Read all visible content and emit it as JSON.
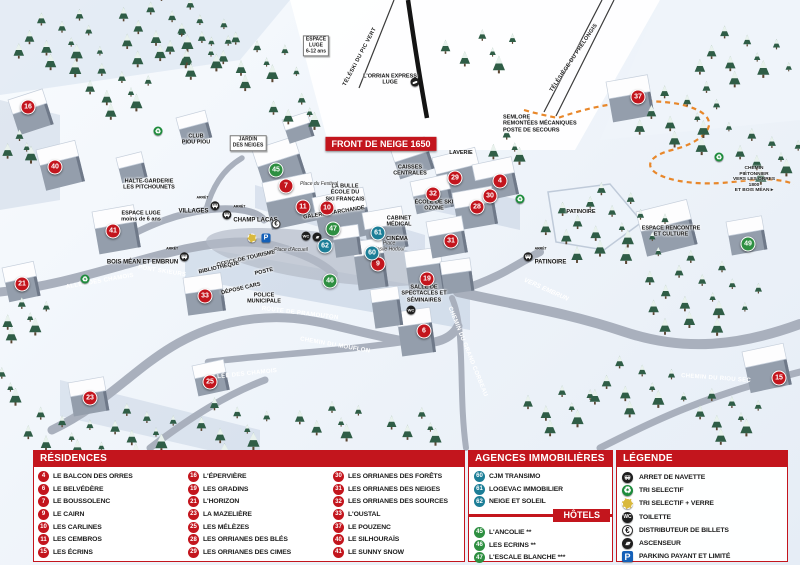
{
  "colors": {
    "residence": "#c3151d",
    "agence": "#1c7e97",
    "hotel": "#2e8f41",
    "legend_red": "#c3151d",
    "parking": "#1460b8",
    "path_orange": "#e8872a"
  },
  "map": {
    "arret_label": "ARRÊT",
    "markers": [
      {
        "n": "16",
        "c": "residence",
        "x": 28,
        "y": 107
      },
      {
        "n": "40",
        "c": "residence",
        "x": 55,
        "y": 167
      },
      {
        "n": "41",
        "c": "residence",
        "x": 113,
        "y": 231
      },
      {
        "n": "21",
        "c": "residence",
        "x": 22,
        "y": 284
      },
      {
        "n": "33",
        "c": "residence",
        "x": 205,
        "y": 296
      },
      {
        "n": "23",
        "c": "residence",
        "x": 90,
        "y": 398
      },
      {
        "n": "25",
        "c": "residence",
        "x": 210,
        "y": 382
      },
      {
        "n": "7",
        "c": "residence",
        "x": 286,
        "y": 186
      },
      {
        "n": "11",
        "c": "residence",
        "x": 303,
        "y": 207
      },
      {
        "n": "10",
        "c": "residence",
        "x": 327,
        "y": 208
      },
      {
        "n": "9",
        "c": "residence",
        "x": 378,
        "y": 264
      },
      {
        "n": "29",
        "c": "residence",
        "x": 455,
        "y": 178
      },
      {
        "n": "4",
        "c": "residence",
        "x": 500,
        "y": 181
      },
      {
        "n": "32",
        "c": "residence",
        "x": 433,
        "y": 194
      },
      {
        "n": "30",
        "c": "residence",
        "x": 490,
        "y": 196
      },
      {
        "n": "28",
        "c": "residence",
        "x": 477,
        "y": 207
      },
      {
        "n": "31",
        "c": "residence",
        "x": 451,
        "y": 241
      },
      {
        "n": "19",
        "c": "residence",
        "x": 427,
        "y": 279
      },
      {
        "n": "6",
        "c": "residence",
        "x": 424,
        "y": 331
      },
      {
        "n": "37",
        "c": "residence",
        "x": 638,
        "y": 97
      },
      {
        "n": "15",
        "c": "residence",
        "x": 779,
        "y": 378
      },
      {
        "n": "45",
        "c": "hotel",
        "x": 276,
        "y": 170
      },
      {
        "n": "47",
        "c": "hotel",
        "x": 333,
        "y": 229
      },
      {
        "n": "46",
        "c": "hotel",
        "x": 330,
        "y": 281
      },
      {
        "n": "49",
        "c": "hotel",
        "x": 748,
        "y": 244
      },
      {
        "n": "62",
        "c": "agence",
        "x": 325,
        "y": 246
      },
      {
        "n": "60",
        "c": "agence",
        "x": 372,
        "y": 253
      },
      {
        "n": "61",
        "c": "agence",
        "x": 378,
        "y": 233
      }
    ],
    "labels": [
      {
        "t": "FRONT DE NEIGE 1650",
        "x": 381,
        "y": 144,
        "cls": "banner"
      },
      {
        "t": "L'ORRIAN EXPRESS\nLUGE",
        "x": 390,
        "y": 80,
        "cls": "poi"
      },
      {
        "t": "TÉLÉSKI DU PIC VERT",
        "x": 360,
        "y": 57,
        "cls": "lift",
        "rot": -62
      },
      {
        "t": "TÉLÉSIÈGE DU PRÉLONGIS",
        "x": 574,
        "y": 58,
        "cls": "lift",
        "rot": -56
      },
      {
        "t": "SEMLORE\nREMONTÉES MÉCANIQUES\nPOSTE DE SECOURS",
        "x": 503,
        "y": 124,
        "cls": "poi poi-left"
      },
      {
        "t": "LAVERIE",
        "x": 461,
        "y": 153,
        "cls": "poi"
      },
      {
        "t": "CAISSES\nCENTRALES",
        "x": 410,
        "y": 171,
        "cls": "poi"
      },
      {
        "t": "LA BULLE\nÉCOLE DU\nSKI FRANÇAIS",
        "x": 345,
        "y": 193,
        "cls": "poi"
      },
      {
        "t": "ÉCOLE DE SKI\nOZONE",
        "x": 434,
        "y": 206,
        "cls": "poi"
      },
      {
        "t": "CABINET\nMÉDICAL",
        "x": 399,
        "y": 222,
        "cls": "poi"
      },
      {
        "t": "CINÉMA",
        "x": 397,
        "y": 239,
        "cls": "poi"
      },
      {
        "t": "GALERIE MARCHANDE",
        "x": 334,
        "y": 213,
        "cls": "poi",
        "rot": -9
      },
      {
        "t": "OFFICE DE TOURISME",
        "x": 246,
        "y": 259,
        "cls": "poi",
        "rot": -13
      },
      {
        "t": "POSTE",
        "x": 264,
        "y": 272,
        "cls": "poi",
        "rot": -13
      },
      {
        "t": "BIBLIOTHÈQUE",
        "x": 219,
        "y": 268,
        "cls": "poi",
        "rot": -13
      },
      {
        "t": "DÉPOSE CARS",
        "x": 241,
        "y": 289,
        "cls": "poi",
        "rot": -13
      },
      {
        "t": "POLICE\nMUNICIPALE",
        "x": 264,
        "y": 299,
        "cls": "poi"
      },
      {
        "t": "SALLE DE\nSPECTACLES ET\nSÉMINAIRES",
        "x": 424,
        "y": 294,
        "cls": "poi"
      },
      {
        "t": "PATINOIRE",
        "x": 581,
        "y": 212,
        "cls": "poi"
      },
      {
        "t": "ESPACE RENCONTRE\nET CULTURE",
        "x": 671,
        "y": 232,
        "cls": "poi"
      },
      {
        "t": "HALTE-GARDERIE\nLES PITCHOUNETS",
        "x": 149,
        "y": 185,
        "cls": "poi"
      },
      {
        "t": "ESPACE LUGE\nmoins de 6 ans",
        "x": 141,
        "y": 217,
        "cls": "poi"
      },
      {
        "t": "CLUB\nPIOU PIOU",
        "x": 196,
        "y": 140,
        "cls": "poi"
      },
      {
        "t": "JARDIN\nDES NEIGES",
        "x": 248,
        "y": 143,
        "cls": "poibox"
      },
      {
        "t": "ESPACE\nLUGE\n6-12 ans",
        "x": 316,
        "y": 46,
        "cls": "poibox"
      },
      {
        "t": "ALLÉE DES CHAMOIS",
        "x": 100,
        "y": 282,
        "cls": "road",
        "rot": -10
      },
      {
        "t": "ALLÉE DES CHAMOIS",
        "x": 243,
        "y": 375,
        "cls": "road",
        "rot": -6
      },
      {
        "t": "PONT SKIEURS",
        "x": 162,
        "y": 272,
        "cls": "road",
        "rot": 9
      },
      {
        "t": "ROUTE DE PRAMOUTON",
        "x": 300,
        "y": 314,
        "cls": "road",
        "rot": 7
      },
      {
        "t": "CHEMIN DU MOUFLON",
        "x": 335,
        "y": 346,
        "cls": "road",
        "rot": 10
      },
      {
        "t": "CHEMIN DU GRAND CORBEAU",
        "x": 467,
        "y": 352,
        "cls": "road",
        "rot": 68
      },
      {
        "t": "CHEMIN DU RIOU SEC",
        "x": 716,
        "y": 379,
        "cls": "road",
        "rot": 4
      },
      {
        "t": "VERS EMBRUN",
        "x": 546,
        "y": 290,
        "cls": "dir",
        "rot": 24
      },
      {
        "t": "Place du Festival",
        "x": 319,
        "y": 185,
        "cls": "place"
      },
      {
        "t": "Place d'Accueil",
        "x": 291,
        "y": 251,
        "cls": "place"
      },
      {
        "t": "Place\nBasile Hodoul",
        "x": 389,
        "y": 247,
        "cls": "place"
      },
      {
        "t": "CHEMIN PIÉTONNIER\nVERS LES ORRES 1800\nET BOIS MÉAN ▸",
        "x": 754,
        "y": 180,
        "cls": "tiny"
      }
    ],
    "stops": [
      {
        "name": "VILLAGES",
        "x": 199,
        "y": 206,
        "side": "r"
      },
      {
        "name": "CHAMP LACAS",
        "x": 250,
        "y": 215,
        "side": "l"
      },
      {
        "name": "BOIS MÉAN ET EMBRUN",
        "x": 148,
        "y": 257,
        "side": "r"
      },
      {
        "name": "PATINOIRE",
        "x": 545,
        "y": 257,
        "side": "l"
      }
    ],
    "icons": [
      {
        "type": "euro",
        "x": 276,
        "y": 224
      },
      {
        "type": "park",
        "x": 266,
        "y": 238
      },
      {
        "type": "verre",
        "x": 252,
        "y": 238
      },
      {
        "type": "wc",
        "x": 306,
        "y": 236
      },
      {
        "type": "asc",
        "x": 317,
        "y": 237
      },
      {
        "type": "wc",
        "x": 411,
        "y": 310
      },
      {
        "type": "recycle",
        "x": 85,
        "y": 279
      },
      {
        "type": "recycle",
        "x": 520,
        "y": 199
      },
      {
        "type": "recycle",
        "x": 719,
        "y": 157
      },
      {
        "type": "recycle",
        "x": 158,
        "y": 131
      },
      {
        "type": "luge",
        "x": 415,
        "y": 82
      }
    ]
  },
  "legend": {
    "residences": {
      "title": "RÉSIDENCES",
      "items": [
        {
          "n": "4",
          "label": "LE BALCON DES ORRES"
        },
        {
          "n": "6",
          "label": "LE BELVÉDÈRE"
        },
        {
          "n": "7",
          "label": "LE BOUSSOLENC"
        },
        {
          "n": "9",
          "label": "LE CAIRN"
        },
        {
          "n": "10",
          "label": "LES CARLINES"
        },
        {
          "n": "11",
          "label": "LES CEMBROS"
        },
        {
          "n": "15",
          "label": "LES ÉCRINS"
        },
        {
          "n": "16",
          "label": "L'ÉPERVIÈRE"
        },
        {
          "n": "19",
          "label": "LES GRADINS"
        },
        {
          "n": "21",
          "label": "L'HORIZON"
        },
        {
          "n": "23",
          "label": "LA MAZELIÈRE"
        },
        {
          "n": "25",
          "label": "LES MÉLÈZES"
        },
        {
          "n": "28",
          "label": "LES ORRIANES DES BLÉS"
        },
        {
          "n": "29",
          "label": "LES ORRIANES DES CIMES"
        },
        {
          "n": "30",
          "label": "LES ORRIANES DES FORÊTS"
        },
        {
          "n": "31",
          "label": "LES ORRIANES DES NEIGES"
        },
        {
          "n": "32",
          "label": "LES ORRIANES DES SOURCES"
        },
        {
          "n": "33",
          "label": "L'OUSTAL"
        },
        {
          "n": "37",
          "label": "LE POUZENC"
        },
        {
          "n": "40",
          "label": "LE SILHOURAÏS"
        },
        {
          "n": "41",
          "label": "LE SUNNY SNOW"
        }
      ]
    },
    "agences": {
      "title": "AGENCES IMMOBILIÈRES",
      "items": [
        {
          "n": "60",
          "label": "CJM TRANSIMO"
        },
        {
          "n": "61",
          "label": "LOGEVAC IMMOBILIER"
        },
        {
          "n": "62",
          "label": "NEIGE ET SOLEIL"
        }
      ]
    },
    "hotels": {
      "title": "HÔTELS",
      "items": [
        {
          "n": "45",
          "label": "L'ANCOLIE **"
        },
        {
          "n": "46",
          "label": "LES ECRINS **"
        },
        {
          "n": "47",
          "label": "L'ESCALE BLANCHE ***"
        },
        {
          "n": "49",
          "label": "LES TRAPPEURS **"
        }
      ]
    },
    "legende": {
      "title": "LÉGENDE",
      "items": [
        {
          "icon": "bus",
          "label": "ARRET DE NAVETTE"
        },
        {
          "icon": "recycle",
          "label": "TRI SELECTIF"
        },
        {
          "icon": "verre",
          "label": "TRI SELECTIF + VERRE"
        },
        {
          "icon": "wc",
          "label": "TOILETTE"
        },
        {
          "icon": "euro",
          "label": "DISTRIBUTEUR DE BILLETS"
        },
        {
          "icon": "asc",
          "label": "ASCENSEUR"
        },
        {
          "icon": "park",
          "label": "PARKING PAYANT ET LIMITÉ"
        }
      ]
    }
  }
}
